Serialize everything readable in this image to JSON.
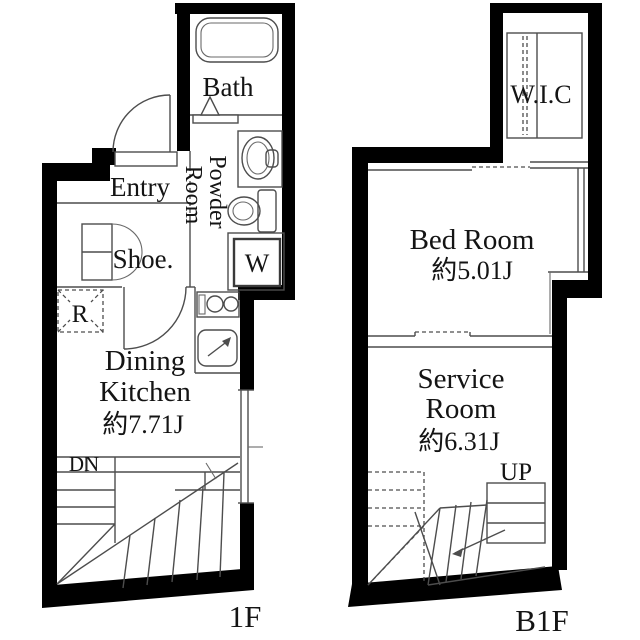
{
  "page": {
    "background": "#ffffff"
  },
  "colors": {
    "wall": "#000000",
    "line": "#4d4d4d",
    "text": "#141414"
  },
  "floor_1f": {
    "floor_label": "1F",
    "bath_label": "Bath",
    "entry_label": "Entry",
    "powder_room_line1": "Powder",
    "powder_room_line2": "Room",
    "washing_machine_label": "W",
    "shoe_label": "Shoe.",
    "refrigerator_label": "R",
    "dining_kitchen_line1": "Dining",
    "dining_kitchen_line2": "Kitchen",
    "dining_kitchen_size": "約7.71J",
    "stairs_label": "DN"
  },
  "floor_b1f": {
    "floor_label": "B1F",
    "wic_label": "W.I.C",
    "bedroom_label": "Bed Room",
    "bedroom_size": "約5.01J",
    "service_room_line1": "Service",
    "service_room_line2": "Room",
    "service_room_size": "約6.31J",
    "stairs_label": "UP"
  }
}
